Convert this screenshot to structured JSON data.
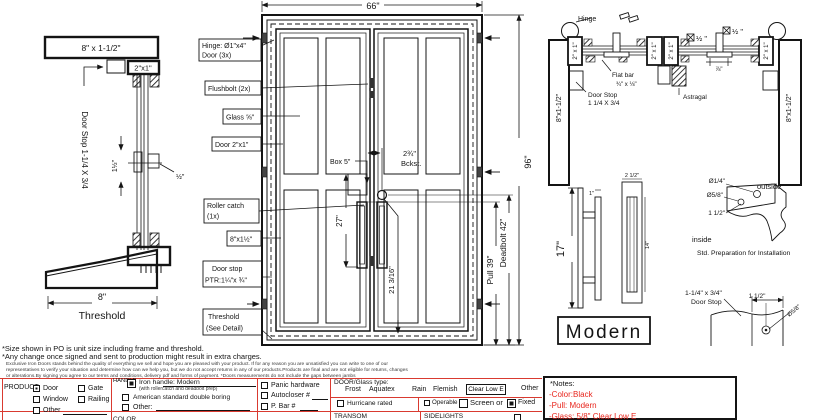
{
  "detail_head": {
    "frame": "8\" x 1-1/2\"",
    "jamb": "2\"x1\"",
    "door_stop": "Door Stop 1-1/4 X 3/4",
    "dim_a": "1½\"",
    "dim_b": "½\"",
    "threshold_dim": "8\"",
    "threshold": "Threshold"
  },
  "elevation": {
    "width": "66\"",
    "height": "96\"",
    "hinge_1": "Hinge: Ø1\"x4\"",
    "hinge_2": "Door (3x)",
    "flushbolt": "Flushbolt (2x)",
    "glass": "Glass ⅝\"",
    "door": "Door 2\"x1\"",
    "roller_1": "Roller catch",
    "roller_2": "(1x)",
    "rail": "8\"x1½\"",
    "stop_1": "Door stop",
    "stop_2": "PTR:1¼\"x ¾\"",
    "th_1": "Threshold",
    "th_2": "(See Detail)",
    "box": "Box 5\"",
    "backset_1": "2¾\"",
    "backset_2": "Bckst.",
    "pull_ht": "27\"",
    "deadbolt_ht": "21 3/16\"",
    "pull": "Pull 39\"",
    "deadbolt": "Deadbolt 42\""
  },
  "section": {
    "hinge": "Hinge",
    "jamb_l": "8\"x1-1/2\"",
    "jamb_r": "8\"x1-1/2\"",
    "stile": "2\" x 1\"",
    "flat_1": "Flat bar",
    "flat_2": "¾\" x ⅛\"",
    "stop_1": "Door Stop",
    "stop_2": "1 1/4 X 3/4",
    "astragal": "Astragal",
    "glass_a": "½ \"",
    "glass_b": "½ \"",
    "gap": "⅞\""
  },
  "handle": {
    "h": "17\"",
    "top": "1\"",
    "w": "2 1/2\"",
    "inner": "14\"",
    "name": "Modern"
  },
  "prep": {
    "hole_small": "Ø1/4\"",
    "hole_big": "Ø5/8\"",
    "offset": "1 1/2\"",
    "outside": "outside",
    "inside": "inside",
    "caption": "Std. Preparation for Installation"
  },
  "stop_profile": {
    "size": "1-1/4\" x 3/4\"",
    "name": "Door Stop",
    "offset": "1 1/2\"",
    "hole": "Ø5/8\"",
    "width": "8\""
  },
  "footnotes": {
    "f1": "*Size shown in PO is unit size including frame and threshold.",
    "f2": "*Any change once signed and sent to production might result in extra charges.",
    "f3": "Exclusive Iron Doors stands behind the quality of everything we sell and hope you are pleased with your product. If for any reason you are unsatisfied you can write to one of our",
    "f4": "representatives to verify your situation and determine how can we help you, but we do not accept returns in any of our products.Products are final and are not eligible for returns, changes",
    "f5": "or alterations.By signing you agree to our terms and conditions, delivery pdf and forms of payment. *Doors measurements do not include the gaps between jambs"
  },
  "form": {
    "product": {
      "label": "PRODUCT:",
      "door": "Door",
      "gate": "Gate",
      "window": "Window",
      "railing": "Railing",
      "other": "Other"
    },
    "handle": {
      "label": "HANDLE",
      "opt1": "Iron handle: Modern",
      "opt1b": "(with rollercatch and deadbolt prep)",
      "opt2": "American standard double boring",
      "opt3": "Other:"
    },
    "hardware": {
      "opt1": "Panic hardware",
      "opt2": "Autocloser #",
      "opt3": "P. Bar #"
    },
    "glass": {
      "label": "DOOR/Glass type:",
      "frost": "Frost",
      "aquatex": "Aquatex",
      "rain": "Rain",
      "flemish": "Flemish",
      "clearlowe": "Clear Low E",
      "other": "Other",
      "hurricane": "Hurricane rated",
      "operable": "Operable",
      "screen": "Screen or",
      "fixed": "Fixed"
    },
    "row2": {
      "color": "COLOR",
      "transom": "TRANSOM",
      "sidelights": "SIDELIGHTS"
    },
    "notes": {
      "title": "*Notes:",
      "l1": "-Color:Black",
      "l2": "-Pull: Modern",
      "l3": "-Glass: 5/8\" Clear Low E"
    }
  }
}
